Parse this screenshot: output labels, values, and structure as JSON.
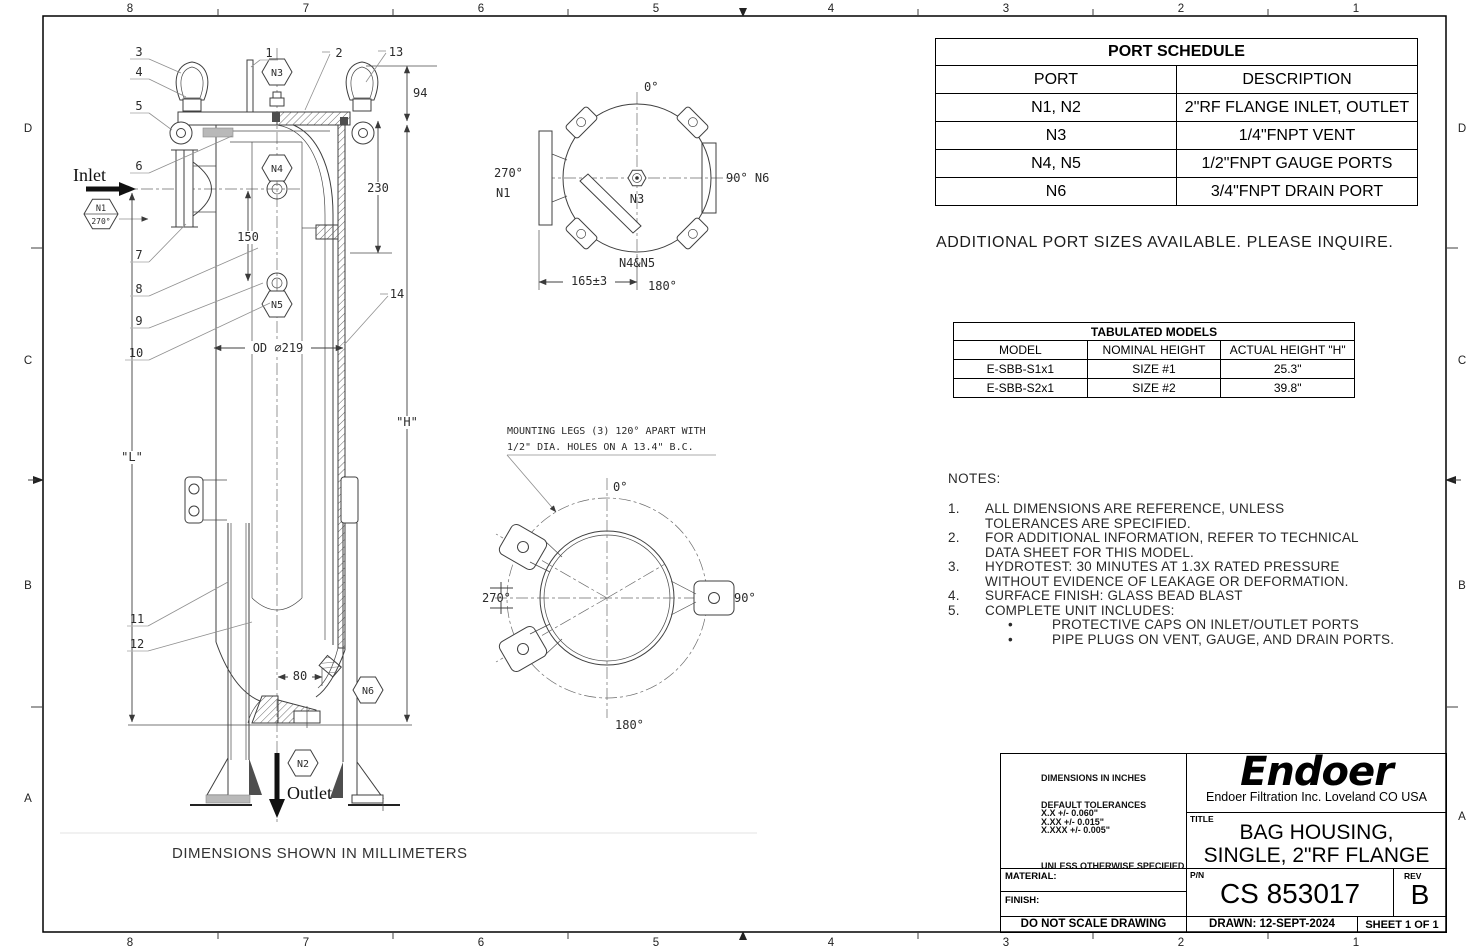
{
  "border": {
    "cols": [
      "8",
      "7",
      "6",
      "5",
      "4",
      "3",
      "2",
      "1"
    ],
    "rows": [
      "D",
      "C",
      "B",
      "A"
    ]
  },
  "side_view": {
    "inlet": "Inlet",
    "outlet": "Outlet",
    "balloons": [
      "1",
      "2",
      "3",
      "4",
      "5",
      "6",
      "7",
      "8",
      "9",
      "10",
      "11",
      "12",
      "13",
      "14"
    ],
    "ports": {
      "n1": "N1",
      "n1_angle": "270°",
      "n2": "N2",
      "n3": "N3",
      "n4": "N4",
      "n5": "N5",
      "n6": "N6"
    },
    "dims": {
      "d94": "94",
      "d230": "230",
      "d150": "150",
      "od": "OD ∅219",
      "h": "\"H\"",
      "l": "\"L\"",
      "d80": "80"
    }
  },
  "top_view": {
    "deg0": "0°",
    "deg270": "270°",
    "deg90n6": "90° N6",
    "deg180": "180°",
    "n1": "N1",
    "n3": "N3",
    "n4n5": "N4&N5",
    "dim": "165±3"
  },
  "bottom_view": {
    "note1": "MOUNTING LEGS (3) 120° APART WITH",
    "note2": "1/2\" DIA. HOLES ON A 13.4\" B.C.",
    "deg0": "0°",
    "deg90": "90°",
    "deg180": "180°",
    "deg270": "270°"
  },
  "footer_note": "DIMENSIONS SHOWN IN MILLIMETERS",
  "port_schedule": {
    "title": "PORT SCHEDULE",
    "headers": [
      "PORT",
      "DESCRIPTION"
    ],
    "rows": [
      [
        "N1, N2",
        "2\"RF FLANGE INLET, OUTLET"
      ],
      [
        "N3",
        "1/4\"FNPT VENT"
      ],
      [
        "N4, N5",
        "1/2\"FNPT GAUGE PORTS"
      ],
      [
        "N6",
        "3/4\"FNPT DRAIN PORT"
      ]
    ]
  },
  "additional_note": "ADDITIONAL PORT SIZES AVAILABLE. PLEASE INQUIRE.",
  "tabulated_models": {
    "title": "TABULATED MODELS",
    "headers": [
      "MODEL",
      "NOMINAL HEIGHT",
      "ACTUAL HEIGHT \"H\""
    ],
    "rows": [
      [
        "E-SBB-S1x1",
        "SIZE #1",
        "25.3\""
      ],
      [
        "E-SBB-S2x1",
        "SIZE #2",
        "39.8\""
      ]
    ]
  },
  "notes": {
    "title": "NOTES:",
    "bullet": "•",
    "items": [
      {
        "num": "1.",
        "text": "ALL DIMENSIONS ARE REFERENCE, UNLESS TOLERANCES ARE SPECIFIED."
      },
      {
        "num": "2.",
        "text": "FOR ADDITIONAL INFORMATION, REFER TO TECHNICAL DATA SHEET FOR THIS MODEL."
      },
      {
        "num": "3.",
        "text": "HYDROTEST: 30 MINUTES AT 1.3X RATED PRESSURE WITHOUT EVIDENCE OF LEAKAGE OR DEFORMATION."
      },
      {
        "num": "4.",
        "text": "SURFACE FINISH: GLASS BEAD BLAST"
      },
      {
        "num": "5.",
        "text": "COMPLETE UNIT INCLUDES:"
      }
    ],
    "bullets": [
      "PROTECTIVE CAPS ON INLET/OUTLET PORTS",
      "PIPE PLUGS ON VENT, GAUGE, AND DRAIN PORTS."
    ]
  },
  "title_block": {
    "dims_in": "DIMENSIONS IN INCHES",
    "default_tol": "DEFAULT TOLERANCES",
    "tol1": "X.X    +/- 0.060\"",
    "tol2": "X.XX  +/- 0.015\"",
    "tol3": "X.XXX +/- 0.005\"",
    "unless": "UNLESS OTHERWISE SPECIFIED",
    "logo": "Endoer",
    "company": "Endoer Filtration Inc.  Loveland CO USA",
    "title_label": "TITLE",
    "title_line1": "BAG HOUSING,",
    "title_line2": "SINGLE, 2\"RF FLANGE",
    "material_label": "MATERIAL:",
    "finish_label": "FINISH:",
    "pn_label": "P/N",
    "pn": "CS 853017",
    "rev_label": "REV",
    "rev": "B",
    "do_not_scale": "DO NOT SCALE DRAWING",
    "drawn": "DRAWN: 12-SEPT-2024",
    "sheet": "SHEET 1 OF 1"
  }
}
